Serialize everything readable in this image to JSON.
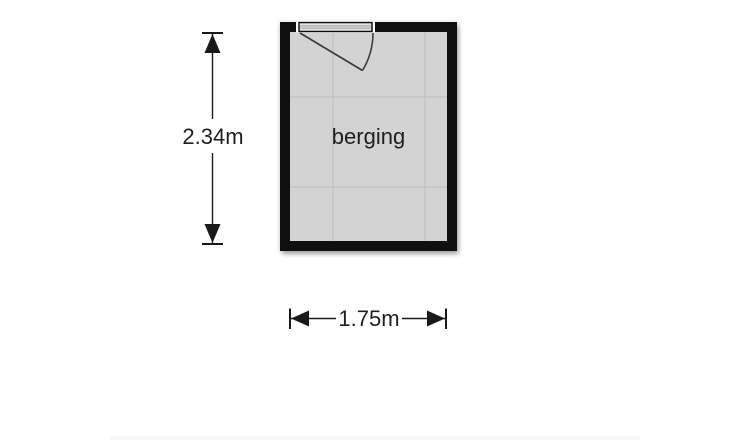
{
  "floorplan": {
    "room": {
      "label": "berging"
    },
    "dimensions": {
      "height_label": "2.34m",
      "width_label": "1.75m"
    },
    "colors": {
      "wall": "#0f0f0f",
      "floor": "#d3d3d3",
      "grid": "#c4c4c4",
      "dimension": "#1a1a1a",
      "text": "#1f1f1f",
      "door_line": "#3d3d3d",
      "threshold_stripe": "#8f8f8f",
      "background": "#ffffff"
    }
  }
}
